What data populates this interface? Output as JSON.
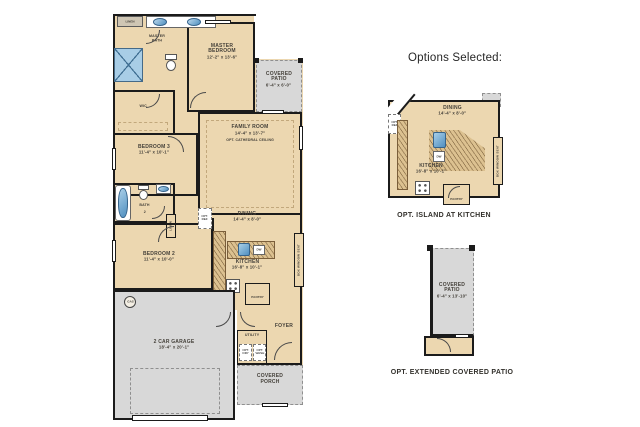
{
  "colors": {
    "floor_tan": "#ecd7b0",
    "outdoor_gray": "#d8d8d8",
    "wall_black": "#1b1b1b",
    "counter_tan": "#dcc190",
    "fixture_blue": "#4f8fc0",
    "label_text": "#45413a"
  },
  "options_header": "Options Selected:",
  "main_plan": {
    "linen_top": "LINEN",
    "master_bath": "MASTER BATH",
    "master_bedroom": {
      "name": "MASTER BEDROOM",
      "dims": "12'-2\" x 13'-6\""
    },
    "covered_patio": {
      "name": "COVERED PATIO",
      "dims": "6'-4\" x 6'-0\""
    },
    "wic": "WIC",
    "bedroom3": {
      "name": "BEDROOM 3",
      "dims": "11'-4\" x 10'-1\""
    },
    "family_room": {
      "name": "FAMILY ROOM",
      "dims": "14'-4\" x 13'-7\"",
      "note": "OPT. CATHEDRAL CEILING"
    },
    "bath2": {
      "name": "BATH",
      "num": "2"
    },
    "linen_side": "LINEN",
    "bedroom2": {
      "name": "BEDROOM 2",
      "dims": "11'-4\" x 10'-0\""
    },
    "dining": {
      "name": "DINING",
      "dims": "14'-4\" x 8'-0\""
    },
    "kitchen": {
      "name": "KITCHEN",
      "dims": "16'-8\" x 10'-1\""
    },
    "opt_ref": {
      "line1": "OPT.",
      "line2": "REF"
    },
    "dw": "DW",
    "pantry": "PANTRY",
    "window_seat": "BOX WINDOW SEAT",
    "garage": {
      "name": "2 CAR GARAGE",
      "dims": "18'-4\" x 20'-1\""
    },
    "gas": "GAS",
    "utility": "UTILITY",
    "opt_dry": {
      "line1": "OPT.",
      "line2": "DRY"
    },
    "opt_wash": {
      "line1": "OPT.",
      "line2": "WASH"
    },
    "foyer": "FOYER",
    "covered_porch": "COVERED PORCH"
  },
  "option_island": {
    "caption": "OPT. ISLAND AT KITCHEN",
    "dining": {
      "name": "DINING",
      "dims": "14'-4\" x 8'-0\""
    },
    "kitchen": {
      "name": "KITCHEN",
      "dims": "16'-8\" x 10'-1\""
    },
    "opt_ref": {
      "line1": "OPT.",
      "line2": "REF"
    },
    "dw": "DW",
    "pantry": "PANTRY",
    "window_seat": "BOX WINDOW SEAT"
  },
  "option_patio": {
    "caption": "OPT. EXTENDED COVERED PATIO",
    "room": {
      "name": "COVERED PATIO",
      "dims": "6'-4\" x 13'-10\""
    }
  }
}
